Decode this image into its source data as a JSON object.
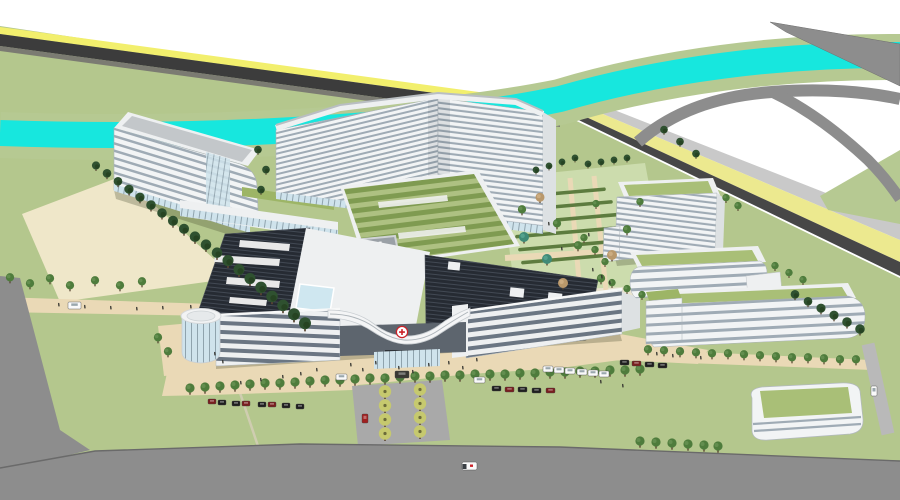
{
  "meta": {
    "description": "Aerial 3D architectural rendering of a hospital campus with a V-shaped inpatient tower, banded white buildings, green roofs, helipad, river and roads"
  },
  "palette": {
    "sky": "#ffffff",
    "grass": "#b4c78d",
    "bank": "#b6c992",
    "garden_lawn": "#ccdcad",
    "hedge": "#5d7c3f",
    "river": "#17e7de",
    "road_gray": "#8d8d8d",
    "road_dark": "#474747",
    "asphalt_dark": "#3c3c3c",
    "road_light": "#c9c9c9",
    "lane_yellow": "#ece98f",
    "yellow_line": "#f2ef6d",
    "path_beige": "#ead9b6",
    "parcel_beige": "#efe7c9",
    "pavement": "#a9a9a9",
    "facade_white": "#f2f4f5",
    "facade_side": "#dde1e3",
    "window_band": "#9fabb5",
    "ribbon_dark": "#6b7683",
    "glass": "#cfe3ec",
    "skylight_blue": "#cfe7f0",
    "roof_gray": "#c3c7ca",
    "roof_rim": "#eef0f1",
    "roof_dark": "#262b33",
    "roof_green_a": "#7f9b51",
    "roof_green_b": "#aec182",
    "green_roof": "#a9bf77",
    "green_strip": "#9db566",
    "tree_green": "#4e7c3c",
    "tree_dark": "#2f5130",
    "tree_teal": "#3f8a77",
    "tree_tan": "#b9986b",
    "tree_yellow": "#c6c96e",
    "trunk": "#5a4632",
    "helipad_gray": "#9aa0a6",
    "red_cross": "#cc2229",
    "car_red": "#7a1f1f",
    "car_red2": "#a02020",
    "car_dark": "#1f1f1f",
    "car_van": "#3a3833",
    "vehicle_white": "#fafafa",
    "person": "#32322e",
    "shadow": "rgba(60,70,40,0.28)"
  },
  "entrance": {
    "emblem_glyph": "✚"
  },
  "scene": {
    "trees": [
      [
        96,
        168,
        "d",
        0.85
      ],
      [
        107,
        176,
        "d",
        0.9
      ],
      [
        118,
        184,
        "d",
        0.9
      ],
      [
        129,
        192,
        "d",
        0.95
      ],
      [
        140,
        200,
        "d",
        0.95
      ],
      [
        151,
        208,
        "d",
        1
      ],
      [
        162,
        216,
        "d",
        1
      ],
      [
        173,
        224,
        "d",
        1.05
      ],
      [
        184,
        232,
        "d",
        1.05
      ],
      [
        195,
        240,
        "d",
        1.1
      ],
      [
        206,
        248,
        "d",
        1.1
      ],
      [
        217,
        256,
        "d",
        1.1
      ],
      [
        228,
        264,
        "d",
        1.15
      ],
      [
        239,
        273,
        "d",
        1.15
      ],
      [
        250,
        282,
        "d",
        1.15
      ],
      [
        261,
        291,
        "d",
        1.2
      ],
      [
        272,
        300,
        "d",
        1.2
      ],
      [
        283,
        309,
        "d",
        1.2
      ],
      [
        294,
        318,
        "d",
        1.25
      ],
      [
        305,
        327,
        "d",
        1.25
      ],
      [
        258,
        152,
        "d",
        0.8
      ],
      [
        266,
        172,
        "d",
        0.8
      ],
      [
        261,
        192,
        "d",
        0.8
      ],
      [
        536,
        172,
        "d",
        0.7
      ],
      [
        549,
        168,
        "d",
        0.7
      ],
      [
        562,
        164,
        "d",
        0.7
      ],
      [
        575,
        160,
        "d",
        0.7
      ],
      [
        588,
        166,
        "d",
        0.7
      ],
      [
        601,
        164,
        "d",
        0.7
      ],
      [
        614,
        162,
        "d",
        0.7
      ],
      [
        627,
        160,
        "d",
        0.7
      ],
      [
        664,
        132,
        "d",
        0.8
      ],
      [
        680,
        144,
        "d",
        0.8
      ],
      [
        696,
        156,
        "d",
        0.8
      ],
      [
        522,
        212,
        "g",
        0.9
      ],
      [
        540,
        200,
        "n",
        0.9
      ],
      [
        557,
        226,
        "g",
        0.9
      ],
      [
        524,
        240,
        "t",
        1
      ],
      [
        547,
        262,
        "t",
        1
      ],
      [
        563,
        286,
        "n",
        1
      ],
      [
        578,
        248,
        "g",
        0.9
      ],
      [
        596,
        206,
        "g",
        0.8
      ],
      [
        612,
        258,
        "n",
        1
      ],
      [
        627,
        232,
        "g",
        0.9
      ],
      [
        640,
        204,
        "g",
        0.8
      ],
      [
        601,
        281,
        "g",
        0.9
      ],
      [
        584,
        240,
        "g",
        0.8
      ],
      [
        595,
        252,
        "g",
        0.8
      ],
      [
        605,
        264,
        "g",
        0.8
      ],
      [
        726,
        200,
        "g",
        0.8
      ],
      [
        738,
        208,
        "g",
        0.8
      ],
      [
        612,
        285,
        "g",
        0.8
      ],
      [
        627,
        291,
        "g",
        0.8
      ],
      [
        642,
        297,
        "g",
        0.8
      ],
      [
        775,
        268,
        "g",
        0.8
      ],
      [
        789,
        275,
        "g",
        0.8
      ],
      [
        803,
        282,
        "g",
        0.8
      ],
      [
        795,
        297,
        "d",
        0.9
      ],
      [
        808,
        304,
        "d",
        0.9
      ],
      [
        821,
        311,
        "d",
        0.95
      ],
      [
        834,
        318,
        "d",
        0.95
      ],
      [
        847,
        325,
        "d",
        1
      ],
      [
        860,
        332,
        "d",
        1
      ],
      [
        190,
        391,
        "g",
        1
      ],
      [
        205,
        390,
        "g",
        1
      ],
      [
        220,
        389,
        "g",
        1
      ],
      [
        235,
        388,
        "g",
        1
      ],
      [
        250,
        387,
        "g",
        1
      ],
      [
        265,
        386,
        "g",
        1
      ],
      [
        280,
        386,
        "g",
        1
      ],
      [
        295,
        385,
        "g",
        1
      ],
      [
        310,
        384,
        "g",
        1
      ],
      [
        325,
        383,
        "g",
        1
      ],
      [
        340,
        383,
        "g",
        1
      ],
      [
        355,
        382,
        "g",
        1
      ],
      [
        370,
        381,
        "g",
        1
      ],
      [
        385,
        381,
        "g",
        1
      ],
      [
        400,
        380,
        "g",
        1
      ],
      [
        415,
        379,
        "g",
        1
      ],
      [
        430,
        379,
        "g",
        1
      ],
      [
        445,
        378,
        "g",
        1
      ],
      [
        460,
        378,
        "g",
        1
      ],
      [
        475,
        377,
        "g",
        1
      ],
      [
        490,
        377,
        "g",
        1
      ],
      [
        505,
        377,
        "g",
        1
      ],
      [
        520,
        376,
        "g",
        1
      ],
      [
        535,
        376,
        "g",
        1
      ],
      [
        550,
        375,
        "g",
        1
      ],
      [
        565,
        375,
        "g",
        1
      ],
      [
        580,
        374,
        "g",
        1
      ],
      [
        595,
        374,
        "g",
        1
      ],
      [
        610,
        373,
        "g",
        1
      ],
      [
        625,
        373,
        "g",
        1
      ],
      [
        640,
        372,
        "g",
        1
      ],
      [
        648,
        352,
        "g",
        0.9
      ],
      [
        664,
        353,
        "g",
        0.9
      ],
      [
        680,
        354,
        "g",
        0.9
      ],
      [
        696,
        355,
        "g",
        0.9
      ],
      [
        712,
        356,
        "g",
        0.9
      ],
      [
        728,
        356,
        "g",
        0.9
      ],
      [
        744,
        357,
        "g",
        0.9
      ],
      [
        760,
        358,
        "g",
        0.9
      ],
      [
        776,
        359,
        "g",
        0.9
      ],
      [
        792,
        360,
        "g",
        0.9
      ],
      [
        808,
        360,
        "g",
        0.9
      ],
      [
        824,
        361,
        "g",
        0.9
      ],
      [
        840,
        362,
        "g",
        0.9
      ],
      [
        856,
        362,
        "g",
        0.9
      ],
      [
        640,
        444,
        "g",
        1
      ],
      [
        656,
        445,
        "g",
        1
      ],
      [
        672,
        446,
        "g",
        1
      ],
      [
        688,
        447,
        "g",
        1
      ],
      [
        704,
        448,
        "g",
        1
      ],
      [
        718,
        449,
        "g",
        1
      ],
      [
        10,
        280,
        "g",
        0.9
      ],
      [
        30,
        286,
        "g",
        0.9
      ],
      [
        50,
        281,
        "g",
        0.9
      ],
      [
        70,
        288,
        "g",
        0.9
      ],
      [
        95,
        283,
        "g",
        0.9
      ],
      [
        120,
        288,
        "g",
        0.9
      ],
      [
        142,
        284,
        "g",
        0.9
      ],
      [
        158,
        340,
        "g",
        0.9
      ],
      [
        168,
        354,
        "g",
        0.9
      ],
      [
        385,
        394,
        "y",
        1
      ],
      [
        420,
        392,
        "y",
        1
      ],
      [
        385,
        408,
        "y",
        1
      ],
      [
        420,
        406,
        "y",
        1
      ],
      [
        385,
        422,
        "y",
        1
      ],
      [
        420,
        420,
        "y",
        1
      ],
      [
        385,
        436,
        "y",
        1
      ],
      [
        420,
        434,
        "y",
        1
      ]
    ],
    "hedges": [
      [
        506,
        196,
        100
      ],
      [
        509,
        209,
        104
      ],
      [
        512,
        222,
        108
      ],
      [
        515,
        235,
        112
      ],
      [
        518,
        248,
        116
      ],
      [
        521,
        261,
        120
      ]
    ],
    "cars": [
      [
        208,
        399,
        8,
        5,
        "car_red"
      ],
      [
        218,
        400,
        8,
        5,
        "car_dark"
      ],
      [
        232,
        401,
        8,
        5,
        "car_dark"
      ],
      [
        242,
        401,
        8,
        5,
        "car_red"
      ],
      [
        258,
        402,
        8,
        5,
        "car_dark"
      ],
      [
        268,
        402,
        8,
        5,
        "car_red"
      ],
      [
        282,
        403,
        8,
        5,
        "car_dark"
      ],
      [
        296,
        404,
        8,
        5,
        "car_dark"
      ],
      [
        492,
        386,
        9,
        5,
        "car_dark"
      ],
      [
        505,
        387,
        9,
        5,
        "car_red"
      ],
      [
        518,
        387,
        9,
        5,
        "car_dark"
      ],
      [
        532,
        388,
        9,
        5,
        "car_dark"
      ],
      [
        546,
        388,
        9,
        5,
        "car_red"
      ],
      [
        620,
        360,
        9,
        5,
        "car_dark"
      ],
      [
        632,
        361,
        9,
        5,
        "car_red"
      ],
      [
        645,
        362,
        9,
        5,
        "car_dark"
      ],
      [
        658,
        363,
        9,
        5,
        "car_dark"
      ],
      [
        543,
        366,
        10,
        6,
        "vehicle_white"
      ],
      [
        554,
        367,
        10,
        6,
        "vehicle_white"
      ],
      [
        565,
        368,
        10,
        6,
        "vehicle_white"
      ],
      [
        577,
        369,
        10,
        6,
        "vehicle_white"
      ],
      [
        588,
        370,
        10,
        6,
        "vehicle_white"
      ],
      [
        599,
        371,
        10,
        6,
        "vehicle_white"
      ],
      [
        395,
        371,
        14,
        7,
        "car_van"
      ],
      [
        474,
        377,
        11,
        6,
        "vehicle_white"
      ],
      [
        336,
        374,
        11,
        6,
        "vehicle_white"
      ],
      [
        362,
        414,
        6,
        9,
        "car_red2"
      ],
      [
        871,
        386,
        6,
        10,
        "vehicle_white"
      ],
      [
        68,
        302,
        13,
        7,
        "vehicle_white"
      ]
    ],
    "people": [
      [
        350,
        363
      ],
      [
        362,
        368
      ],
      [
        375,
        361
      ],
      [
        398,
        366
      ],
      [
        412,
        370
      ],
      [
        428,
        363
      ],
      [
        448,
        361
      ],
      [
        462,
        366
      ],
      [
        476,
        358
      ],
      [
        316,
        368
      ],
      [
        300,
        372
      ],
      [
        282,
        375
      ],
      [
        260,
        378
      ],
      [
        240,
        381
      ],
      [
        58,
        303
      ],
      [
        84,
        305
      ],
      [
        110,
        306
      ],
      [
        136,
        307
      ],
      [
        162,
        306
      ],
      [
        190,
        305
      ],
      [
        214,
        352
      ],
      [
        222,
        360
      ],
      [
        548,
        222
      ],
      [
        561,
        247
      ],
      [
        588,
        233
      ],
      [
        592,
        268
      ],
      [
        601,
        275
      ],
      [
        609,
        281
      ],
      [
        656,
        352
      ],
      [
        672,
        354
      ],
      [
        700,
        356
      ],
      [
        600,
        380
      ],
      [
        622,
        384
      ]
    ]
  }
}
